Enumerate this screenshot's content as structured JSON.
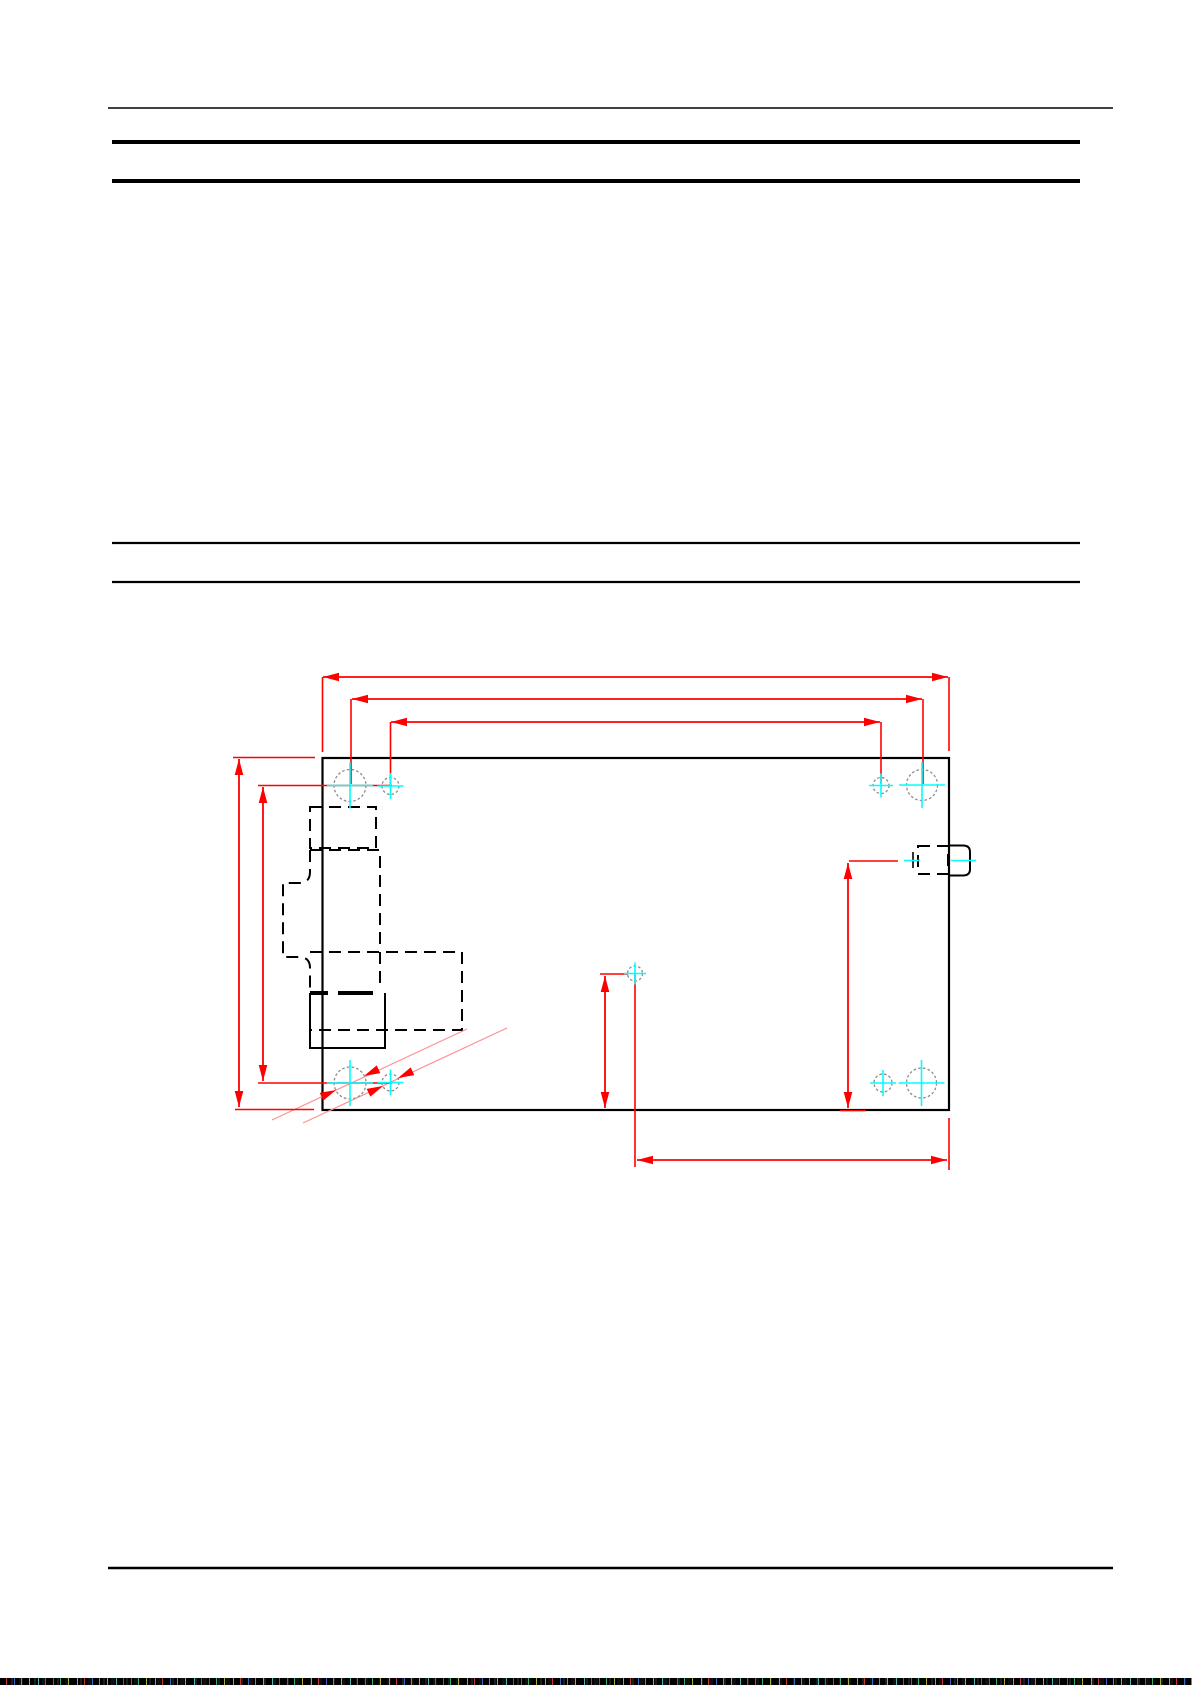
{
  "page": {
    "width_px": 1192,
    "height_px": 1685,
    "background": "#ffffff"
  },
  "colors": {
    "rule_black": "#000000",
    "outline_black": "#000000",
    "dimension_red": "#ff0000",
    "leader_pink": "#ff9090",
    "centerline_cyan": "#00ffff",
    "hole_gray": "#8c8c8c"
  },
  "rules": [
    {
      "name": "top-rule",
      "x1": 108,
      "y1": 108,
      "x2": 1113,
      "y2": 108,
      "w": 1.6
    },
    {
      "name": "header-bar-1",
      "x1": 112,
      "y1": 142,
      "x2": 1080,
      "y2": 142,
      "w": 4
    },
    {
      "name": "header-bar-2",
      "x1": 112,
      "y1": 181,
      "x2": 1080,
      "y2": 181,
      "w": 4
    },
    {
      "name": "section-rule-1",
      "x1": 112,
      "y1": 543,
      "x2": 1080,
      "y2": 543,
      "w": 2.2
    },
    {
      "name": "section-rule-2",
      "x1": 112,
      "y1": 582,
      "x2": 1080,
      "y2": 582,
      "w": 2.2
    },
    {
      "name": "footer-rule",
      "x1": 108,
      "y1": 1568,
      "x2": 1113,
      "y2": 1568,
      "w": 2.4
    }
  ],
  "drawing": {
    "board": {
      "x": 322.5,
      "y": 758,
      "w": 626.5,
      "h": 352,
      "stroke_w": 2.2
    },
    "dashed_shapes": [
      {
        "name": "left-connector-a",
        "d": "M310 807 H376 V848 H310 Z"
      },
      {
        "name": "left-connector-b",
        "d": "M310 850 H380 V950"
      },
      {
        "name": "left-connector-b-step",
        "d": "M310 850 V872 Q310 883 299 883 H283 V957 H299 Q310 957 310 968 V991"
      },
      {
        "name": "left-connector-c",
        "d": "M310 952 H462 V1030 H310"
      },
      {
        "name": "left-connector-c-inner",
        "d": "M380 952 V985"
      },
      {
        "name": "right-connector-hidden",
        "d": "M918 846 H948 V874 H918 Z"
      }
    ],
    "solid_shapes": [
      {
        "name": "left-connector-d",
        "d": "M310 993 V1048 H385 V993",
        "w": 2
      },
      {
        "name": "right-connector-tab",
        "d": "M949 845.5 H963 Q970 845.5 970 852 V869 Q970 875.5 963 875.5 H949",
        "w": 2
      },
      {
        "name": "connector-d-bold-edge-1",
        "d": "M310 993 H328",
        "w": 4
      },
      {
        "name": "connector-d-bold-edge-2",
        "d": "M338 993 H373",
        "w": 4
      }
    ],
    "black_marks": [
      {
        "name": "center-mark",
        "x1": 913,
        "y1": 852,
        "x2": 913,
        "y2": 868,
        "w": 1.6
      }
    ],
    "red_dim_lines": [
      {
        "x1": 323,
        "y1": 677,
        "x2": 948,
        "y2": 677
      },
      {
        "x1": 352,
        "y1": 699,
        "x2": 922,
        "y2": 699
      },
      {
        "x1": 391,
        "y1": 722,
        "x2": 880,
        "y2": 722
      },
      {
        "x1": 239,
        "y1": 759,
        "x2": 239,
        "y2": 1107
      },
      {
        "x1": 263,
        "y1": 787,
        "x2": 263,
        "y2": 1081
      },
      {
        "x1": 848,
        "y1": 863,
        "x2": 848,
        "y2": 1108
      },
      {
        "x1": 605,
        "y1": 976,
        "x2": 605,
        "y2": 1108
      },
      {
        "x1": 637,
        "y1": 1160,
        "x2": 947,
        "y2": 1160
      }
    ],
    "red_ext_lines": [
      {
        "x1": 322.5,
        "y1": 677,
        "x2": 322.5,
        "y2": 752
      },
      {
        "x1": 949,
        "y1": 677,
        "x2": 949,
        "y2": 751
      },
      {
        "x1": 351,
        "y1": 699,
        "x2": 351,
        "y2": 784
      },
      {
        "x1": 923,
        "y1": 699,
        "x2": 923,
        "y2": 784
      },
      {
        "x1": 390.5,
        "y1": 722,
        "x2": 390.5,
        "y2": 785
      },
      {
        "x1": 881,
        "y1": 722,
        "x2": 881,
        "y2": 784
      },
      {
        "x1": 233,
        "y1": 757.5,
        "x2": 315,
        "y2": 757.5
      },
      {
        "x1": 235,
        "y1": 1109.5,
        "x2": 314,
        "y2": 1109.5
      },
      {
        "x1": 258,
        "y1": 785.5,
        "x2": 392,
        "y2": 785.5
      },
      {
        "x1": 258,
        "y1": 1083,
        "x2": 392,
        "y2": 1083
      },
      {
        "x1": 849,
        "y1": 861,
        "x2": 898,
        "y2": 861
      },
      {
        "x1": 840,
        "y1": 1110.5,
        "x2": 866,
        "y2": 1110.5
      },
      {
        "x1": 600,
        "y1": 974,
        "x2": 628,
        "y2": 974
      },
      {
        "x1": 635,
        "y1": 974,
        "x2": 635,
        "y2": 1167
      },
      {
        "x1": 949,
        "y1": 1118,
        "x2": 949,
        "y2": 1170
      }
    ],
    "red_arrows": [
      {
        "x": 323,
        "y": 677,
        "a": 180
      },
      {
        "x": 948,
        "y": 677,
        "a": 0
      },
      {
        "x": 352,
        "y": 699,
        "a": 180
      },
      {
        "x": 922,
        "y": 699,
        "a": 0
      },
      {
        "x": 391,
        "y": 722,
        "a": 180
      },
      {
        "x": 880,
        "y": 722,
        "a": 0
      },
      {
        "x": 239,
        "y": 759,
        "a": 270
      },
      {
        "x": 239,
        "y": 1107,
        "a": 90
      },
      {
        "x": 263,
        "y": 787,
        "a": 270
      },
      {
        "x": 263,
        "y": 1081,
        "a": 90
      },
      {
        "x": 848,
        "y": 863,
        "a": 270
      },
      {
        "x": 848,
        "y": 1108,
        "a": 90
      },
      {
        "x": 605,
        "y": 976,
        "a": 270
      },
      {
        "x": 605,
        "y": 1108,
        "a": 90
      },
      {
        "x": 637,
        "y": 1160,
        "a": 180
      },
      {
        "x": 947,
        "y": 1160,
        "a": 0
      },
      {
        "x": 336,
        "y": 1090,
        "a": -25
      },
      {
        "x": 364,
        "y": 1076,
        "a": 155
      },
      {
        "x": 383,
        "y": 1086,
        "a": -25
      },
      {
        "x": 398,
        "y": 1078,
        "a": 155
      }
    ],
    "pink_lines": [
      {
        "x1": 272,
        "y1": 1120,
        "x2": 467,
        "y2": 1029
      },
      {
        "x1": 303,
        "y1": 1123,
        "x2": 507,
        "y2": 1028
      }
    ],
    "holes": [
      {
        "cx": 350,
        "cy": 785.5,
        "r": 16,
        "cross": 23
      },
      {
        "cx": 390.5,
        "cy": 786,
        "r": 8.5,
        "cross": 13
      },
      {
        "cx": 881,
        "cy": 785.5,
        "r": 8,
        "cross": 12
      },
      {
        "cx": 922,
        "cy": 785,
        "r": 15.5,
        "cross": 23
      },
      {
        "cx": 350,
        "cy": 1083,
        "r": 16,
        "cross": 23
      },
      {
        "cx": 390.5,
        "cy": 1082.5,
        "r": 8.5,
        "cross": 13
      },
      {
        "cx": 883,
        "cy": 1083,
        "r": 9,
        "cross": 13
      },
      {
        "cx": 921.5,
        "cy": 1083,
        "r": 15,
        "cross": 23
      },
      {
        "cx": 635,
        "cy": 973.5,
        "r": 7.5,
        "cross": 11
      }
    ],
    "cyan_lines": [
      {
        "x1": 904,
        "y1": 860.5,
        "x2": 920,
        "y2": 860.5
      },
      {
        "x1": 951,
        "y1": 860.5,
        "x2": 976,
        "y2": 860.5
      }
    ]
  },
  "artifact_strip": {
    "height_px": 7
  }
}
